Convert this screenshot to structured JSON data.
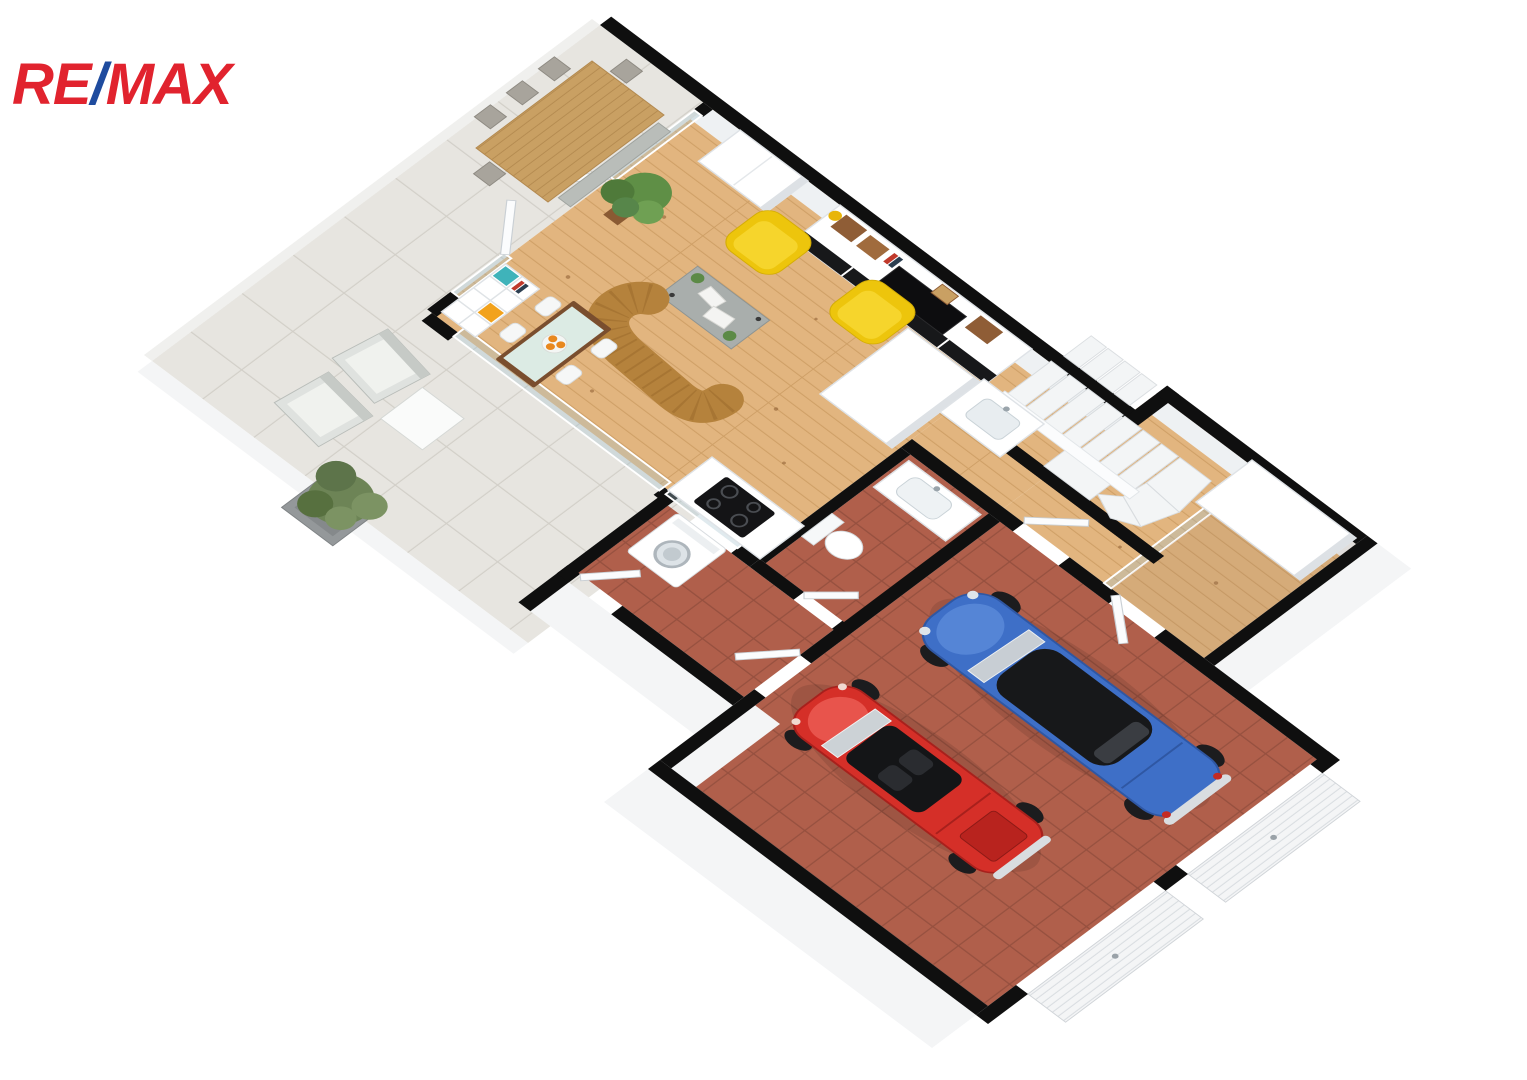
{
  "logo": {
    "re": "RE",
    "slash": "/",
    "max": "MAX",
    "color_red": "#E1232E",
    "color_blue": "#1E4B9E"
  },
  "floor_plan": {
    "type": "3d-isometric-floor-plan",
    "level": "ground-floor-with-garage",
    "rooms": [
      {
        "name": "terrace",
        "floor": "light-gray-stone-tiles",
        "floor_color": "#e7e5e0"
      },
      {
        "name": "dining-balcony",
        "floor": "light-gray-stone-tiles",
        "floor_color": "#e7e5e0"
      },
      {
        "name": "living-room",
        "floor": "light-pine-wood",
        "floor_color": "#e2b57f"
      },
      {
        "name": "kitchen",
        "floor": "light-pine-wood",
        "floor_color": "#e2b57f"
      },
      {
        "name": "bathroom",
        "floor": "terracotta-tiles",
        "floor_color": "#b05f4b"
      },
      {
        "name": "utility-room",
        "floor": "terracotta-tiles",
        "floor_color": "#b05f4b"
      },
      {
        "name": "hallway",
        "floor": "light-pine-wood",
        "floor_color": "#e2b57f"
      },
      {
        "name": "staircase",
        "floor": "white-steps",
        "floor_color": "#f3f5f6"
      },
      {
        "name": "entry-vestibule",
        "floor": "light-pine-wood",
        "floor_color": "#e2b57f"
      },
      {
        "name": "garage",
        "floor": "terracotta-tiles",
        "floor_color": "#b05f4b"
      }
    ],
    "furniture": [
      "outdoor-dining-table-with-bench-and-chairs",
      "outdoor-lounge-chairs",
      "outdoor-side-table",
      "olive-tree-planter",
      "kallax-shelf-teal-orange-boxes",
      "french-doors",
      "indoor-dining-table-with-oranges",
      "white-shell-chairs",
      "curved-mustard-sofa",
      "concrete-coffee-table",
      "yellow-tub-armchair",
      "yellow-tub-armchair",
      "white-wardrobe",
      "tv-wall-unit-with-wooden-crates",
      "potted-plant",
      "kitchen-tall-cabinet",
      "kitchen-sink",
      "induction-cooktop",
      "bathroom-vanity-sink",
      "toilet",
      "washing-machine",
      "winder-staircase",
      "entry-closet",
      "sectional-garage-doors"
    ],
    "vehicles": [
      {
        "type": "classic-hardtop-car",
        "color": "#3E6FC7",
        "roof": "#17181A"
      },
      {
        "type": "classic-convertible-car",
        "color": "#D52F28",
        "cockpit": "#141517"
      }
    ],
    "palette": {
      "walls_cut": "#0f0f0f",
      "walls_white": "#f4f5f6",
      "wood_floor": "#e2b57f",
      "terracotta_floor": "#b05f4b",
      "terrace_tile": "#e7e5e0",
      "sofa_mustard": "#b5823c",
      "armchair_yellow": "#edc50c",
      "kallax_teal": "#3fb3ba",
      "kallax_orange": "#f2a21c",
      "car_blue": "#3E6FC7",
      "car_red": "#D52F28",
      "plant_green": "#6d8456"
    }
  }
}
